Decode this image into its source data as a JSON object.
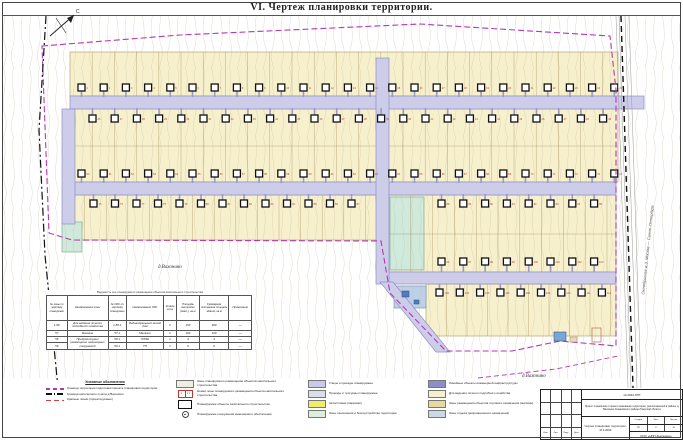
{
  "title": "VI.    Чертеж планировки территории.",
  "map": {
    "labels": {
      "north": "С",
      "settlement_left": "д.Вахонино",
      "settlement_bottom": "д.Вахонино",
      "railway": "Октябрьская ж.д.  Москва — Санкт-Петербург"
    },
    "colors": {
      "parcel": "#f7f0cd",
      "road": "#cdcdea",
      "green_zone": "#cfe9db",
      "blue_zone": "#bcd0e8",
      "boundary": "#b23ab2",
      "house_number": "#c0392b"
    },
    "parcel_bands": [
      {
        "x": 70,
        "y": 52,
        "w": 548,
        "h": 44,
        "dx": 22.2
      },
      {
        "x": 70,
        "y": 109,
        "w": 548,
        "h": 73,
        "dx": 22.2,
        "hsplit": 146
      },
      {
        "x": 63,
        "y": 195,
        "w": 317,
        "h": 45,
        "dx": 21.6
      },
      {
        "x": 389,
        "y": 195,
        "w": 227,
        "h": 77,
        "dx": 21.8,
        "hsplit": 234
      },
      {
        "x": 426,
        "y": 284,
        "w": 190,
        "h": 52,
        "dx": 20.5
      }
    ],
    "special_parcels": [
      {
        "x": 390,
        "y": 197,
        "w": 34,
        "h": 73,
        "fill": "#cfe9db",
        "stroke": "#7fae93"
      },
      {
        "x": 62,
        "y": 222,
        "w": 20,
        "h": 30,
        "fill": "#cfe9db",
        "stroke": "#7fae93"
      },
      {
        "x": 394,
        "y": 286,
        "w": 32,
        "h": 22,
        "fill": "#bcd0e8",
        "stroke": "#7f95ae"
      }
    ],
    "house_rows": [
      {
        "y": 84,
        "x0": 78,
        "n": 25,
        "dx": 22.2,
        "road_y": 97
      },
      {
        "y": 115,
        "x0": 89,
        "n": 24,
        "dx": 22.2,
        "road_y": 108
      },
      {
        "y": 170,
        "x0": 78,
        "n": 25,
        "dx": 22.2,
        "road_y": 183
      },
      {
        "y": 200,
        "x0": 90,
        "n": 13,
        "dx": 21.5,
        "road_y": 194
      },
      {
        "y": 200,
        "x0": 438,
        "n": 8,
        "dx": 21.8,
        "road_y": 194
      },
      {
        "y": 258,
        "x0": 438,
        "n": 8,
        "dx": 21.8,
        "road_y": 272
      },
      {
        "y": 289,
        "x0": 436,
        "n": 9,
        "dx": 20.3,
        "road_y": 284
      }
    ]
  },
  "table": {
    "caption": "Ведомость зон планируемого размещения объектов капитального строительства",
    "headers": [
      "№ зоны по чертежу планировки",
      "Наименование зоны",
      "№ ОКС по чертежу планировки",
      "Наименование ОКС",
      "Этажность",
      "Площадь застройки (макс.), кв.м",
      "Суммарная поэтажная площадь здания, кв.м",
      "Примечание"
    ],
    "rows": [
      [
        "1-56",
        "Для ведения личного подсобного хозяйства",
        "1-56.1",
        "Индивидуальный жилой дом",
        "2",
        "150",
        "300",
        "—"
      ],
      [
        "57",
        "Магазин",
        "57.1",
        "Магазин",
        "1",
        "100",
        "100",
        "—"
      ],
      [
        "58",
        {
          "text": "Предусмотрено размещение инженерных сооружений",
          "rowspan": 2
        },
        "58.1",
        "ГРПШ",
        "1",
        "4",
        "4",
        "—"
      ],
      [
        "59",
        "59.1",
        "ТП",
        "1",
        "6",
        "6",
        "—"
      ]
    ]
  },
  "legend": {
    "heading": "Условные обозначения",
    "line_items": [
      {
        "kind": "project-boundary",
        "label": "Граница территории подготовки проекта планировки территории"
      },
      {
        "kind": "settlement-boundary",
        "label": "Граница населенного пункта д.Вахонино"
      },
      {
        "kind": "red-lines",
        "label": "Красные линии (проектируемые)"
      }
    ],
    "symbol_items": [
      {
        "kind": "zone-box",
        "label": "Зоны планируемого размещения объектов капитального строительства"
      },
      {
        "kind": "zone-number",
        "sample_left": "1",
        "sample_right": "1.1",
        "label": "Номер зоны планируемого размещения объекта капитального строительства"
      },
      {
        "kind": "building-rect",
        "label": "Планируемые объекты капитального строительства"
      },
      {
        "kind": "well-circle",
        "label": "Планируемые сооружения инженерного обеспечения"
      }
    ],
    "surface_items": [
      {
        "color": "#c9c9e8",
        "label": "Улицы и проезды планируемые"
      },
      {
        "color": "#dadee8",
        "label": "Проезды и тротуары планируемые"
      },
      {
        "color": "#f0ec6c",
        "label": "Автостоянки (парковки)"
      },
      {
        "color": "#ddeedd",
        "label": "Зоны озеленения и благоустройства территории"
      }
    ],
    "zone_items": [
      {
        "color": "#8d8dc9",
        "label": "Линейные объекты инженерной инфраструктуры"
      },
      {
        "color": "#f7f0cd",
        "label": "Для ведения личного подсобного хозяйства"
      },
      {
        "color": "#e8d9a0",
        "label": "Зоны размещения объектов торгового назначения (магазин)"
      },
      {
        "color": "#ccd9e4",
        "label": "Зоны отдыха (рекреационного назначения)"
      }
    ]
  },
  "stamp": {
    "doc_number": "14-2023-ППТ",
    "project": "Проект планировки и проект межевания территории, расположенной в районе д. Вахонино Конаковского района Тверской области",
    "sheet_title": "Чертеж планировки территории. М 1:2000",
    "meta_headers": [
      "Стадия",
      "Лист",
      "Листов"
    ],
    "meta_values": [
      "ПП",
      "6",
      "16"
    ],
    "org": "ООО «НПП Землемер»",
    "sig_headers": [
      "Изм.",
      "Лист",
      "Подп.",
      "Дата"
    ]
  }
}
